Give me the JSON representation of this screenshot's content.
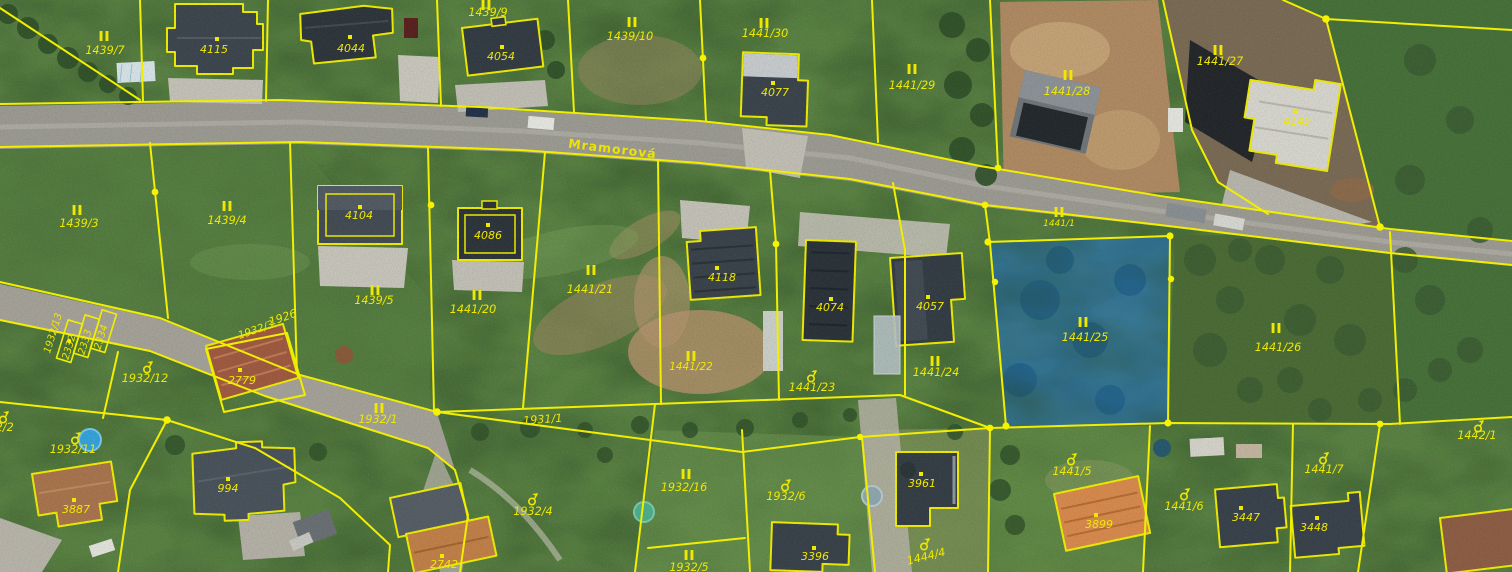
{
  "map": {
    "street_label": {
      "text": "Mramorová",
      "x": 612,
      "y": 153,
      "rotation": 7
    },
    "selection": {
      "parcel": "1441/25",
      "fill": "#1e6fd2",
      "fill_opacity": 0.55
    },
    "colors": {
      "boundary_line": "#f2ee00",
      "parcel_label": "#efe800",
      "selection_fill": "#1e6fd2"
    },
    "marker_legend": {
      "grass": "permanent-grassland-marker",
      "garden": "garden-marker",
      "dot": "building-point"
    },
    "parcel_labels": [
      {
        "label": "1439/7",
        "x": 105,
        "y": 54,
        "marker": {
          "type": "grass",
          "x": 104,
          "y": 36
        }
      },
      {
        "label": "1439/9",
        "x": 488,
        "y": 16,
        "marker": {
          "type": "grass",
          "x": 486,
          "y": 5
        }
      },
      {
        "label": "1439/10",
        "x": 630,
        "y": 40,
        "marker": {
          "type": "grass",
          "x": 632,
          "y": 22
        }
      },
      {
        "label": "1441/30",
        "x": 765,
        "y": 37,
        "marker": {
          "type": "grass",
          "x": 764,
          "y": 23
        }
      },
      {
        "label": "1441/29",
        "x": 912,
        "y": 89,
        "marker": {
          "type": "grass",
          "x": 912,
          "y": 69
        }
      },
      {
        "label": "1441/28",
        "x": 1067,
        "y": 95,
        "marker": {
          "type": "grass",
          "x": 1068,
          "y": 75
        }
      },
      {
        "label": "1441/27",
        "x": 1220,
        "y": 65,
        "marker": {
          "type": "grass",
          "x": 1218,
          "y": 50
        }
      },
      {
        "label": "1439/3",
        "x": 79,
        "y": 227,
        "marker": {
          "type": "grass",
          "x": 77,
          "y": 210
        }
      },
      {
        "label": "1439/4",
        "x": 227,
        "y": 224,
        "marker": {
          "type": "grass",
          "x": 227,
          "y": 206
        }
      },
      {
        "label": "1439/5",
        "x": 374,
        "y": 304,
        "marker": {
          "type": "grass",
          "x": 375,
          "y": 290
        }
      },
      {
        "label": "1441/20",
        "x": 473,
        "y": 313,
        "marker": {
          "type": "grass",
          "x": 477,
          "y": 295
        }
      },
      {
        "label": "1441/21",
        "x": 590,
        "y": 293,
        "marker": {
          "type": "grass",
          "x": 591,
          "y": 270
        }
      },
      {
        "label": "1441/22",
        "x": 691,
        "y": 370,
        "size": 10.5,
        "marker": {
          "type": "grass",
          "x": 691,
          "y": 356
        }
      },
      {
        "label": "1441/23",
        "x": 812,
        "y": 391,
        "marker": {
          "type": "garden",
          "x": 811,
          "y": 376
        }
      },
      {
        "label": "1441/24",
        "x": 936,
        "y": 376,
        "marker": {
          "type": "grass",
          "x": 935,
          "y": 361
        }
      },
      {
        "label": "1441/25",
        "x": 1085,
        "y": 341,
        "marker": {
          "type": "grass",
          "x": 1083,
          "y": 322
        }
      },
      {
        "label": "1441/26",
        "x": 1278,
        "y": 351,
        "marker": {
          "type": "grass",
          "x": 1276,
          "y": 328
        }
      },
      {
        "label": "1441/1",
        "x": 1059,
        "y": 226,
        "size": 9,
        "marker": {
          "type": "grass",
          "x": 1059,
          "y": 212
        }
      },
      {
        "label": "1926",
        "x": 284,
        "y": 321,
        "rotation": -19
      },
      {
        "label": "1932/3",
        "x": 257,
        "y": 333,
        "rotation": -19,
        "size": 10.5
      },
      {
        "label": "1932/13",
        "x": 56,
        "y": 334,
        "rotation": -73,
        "size": 10
      },
      {
        "label": "2332",
        "x": 72,
        "y": 348,
        "rotation": -73,
        "size": 10
      },
      {
        "label": "2333",
        "x": 88,
        "y": 343,
        "rotation": -73,
        "size": 10
      },
      {
        "label": "2334",
        "x": 104,
        "y": 338,
        "rotation": -73,
        "size": 10
      },
      {
        "label": "1932/12",
        "x": 145,
        "y": 382,
        "marker": {
          "type": "garden",
          "x": 147,
          "y": 367
        }
      },
      {
        "label": "1932/2",
        "x": -6,
        "y": 431,
        "marker": {
          "type": "garden",
          "x": 3,
          "y": 417
        }
      },
      {
        "label": "1932/11",
        "x": 73,
        "y": 453,
        "marker": {
          "type": "garden",
          "x": 75,
          "y": 438
        }
      },
      {
        "label": "1932/1",
        "x": 378,
        "y": 423,
        "marker": {
          "type": "grass",
          "x": 379,
          "y": 408
        }
      },
      {
        "label": "1931/1",
        "x": 543,
        "y": 423,
        "rotation": -4
      },
      {
        "label": "1932/4",
        "x": 533,
        "y": 515,
        "marker": {
          "type": "garden",
          "x": 532,
          "y": 499
        }
      },
      {
        "label": "1932/16",
        "x": 684,
        "y": 491,
        "marker": {
          "type": "grass",
          "x": 686,
          "y": 474
        }
      },
      {
        "label": "1932/5",
        "x": 689,
        "y": 571,
        "marker": {
          "type": "grass",
          "x": 689,
          "y": 555
        }
      },
      {
        "label": "1932/6",
        "x": 786,
        "y": 500,
        "marker": {
          "type": "garden",
          "x": 785,
          "y": 485
        }
      },
      {
        "label": "1444/4",
        "x": 927,
        "y": 560,
        "rotation": -14,
        "marker": {
          "type": "garden",
          "x": 924,
          "y": 544
        }
      },
      {
        "label": "1441/5",
        "x": 1072,
        "y": 475,
        "marker": {
          "type": "garden",
          "x": 1071,
          "y": 459
        }
      },
      {
        "label": "1441/6",
        "x": 1184,
        "y": 510,
        "marker": {
          "type": "garden",
          "x": 1184,
          "y": 494
        }
      },
      {
        "label": "1441/7",
        "x": 1324,
        "y": 473,
        "marker": {
          "type": "garden",
          "x": 1323,
          "y": 458
        }
      },
      {
        "label": "1442/1",
        "x": 1477,
        "y": 439,
        "marker": {
          "type": "garden",
          "x": 1478,
          "y": 426
        }
      }
    ],
    "building_labels": [
      {
        "label": "4115",
        "x": 214,
        "y": 53,
        "dot": {
          "x": 217,
          "y": 39
        }
      },
      {
        "label": "4044",
        "x": 351,
        "y": 52,
        "dot": {
          "x": 350,
          "y": 37
        }
      },
      {
        "label": "4054",
        "x": 501,
        "y": 60,
        "dot": {
          "x": 502,
          "y": 47
        }
      },
      {
        "label": "4077",
        "x": 775,
        "y": 96,
        "dot": {
          "x": 773,
          "y": 83
        }
      },
      {
        "label": "4149",
        "x": 1297,
        "y": 125,
        "dot": {
          "x": 1295,
          "y": 112
        }
      },
      {
        "label": "4104",
        "x": 359,
        "y": 219,
        "dot": {
          "x": 360,
          "y": 207
        }
      },
      {
        "label": "4086",
        "x": 488,
        "y": 239,
        "dot": {
          "x": 488,
          "y": 225
        }
      },
      {
        "label": "4118",
        "x": 722,
        "y": 281,
        "dot": {
          "x": 717,
          "y": 268
        }
      },
      {
        "label": "4074",
        "x": 830,
        "y": 311,
        "dot": {
          "x": 831,
          "y": 299
        }
      },
      {
        "label": "4057",
        "x": 930,
        "y": 310,
        "dot": {
          "x": 928,
          "y": 297
        }
      },
      {
        "label": "2779",
        "x": 242,
        "y": 384,
        "dot": {
          "x": 240,
          "y": 370
        }
      },
      {
        "label": "3887",
        "x": 76,
        "y": 513,
        "dot": {
          "x": 74,
          "y": 500
        }
      },
      {
        "label": "994",
        "x": 228,
        "y": 492,
        "dot": {
          "x": 228,
          "y": 479
        }
      },
      {
        "label": "2742",
        "x": 444,
        "y": 568,
        "dot": {
          "x": 442,
          "y": 556
        }
      },
      {
        "label": "3396",
        "x": 815,
        "y": 560,
        "dot": {
          "x": 814,
          "y": 548
        }
      },
      {
        "label": "3961",
        "x": 922,
        "y": 487,
        "dot": {
          "x": 921,
          "y": 474
        }
      },
      {
        "label": "3899",
        "x": 1099,
        "y": 528,
        "dot": {
          "x": 1096,
          "y": 515
        }
      },
      {
        "label": "3447",
        "x": 1246,
        "y": 521,
        "dot": {
          "x": 1241,
          "y": 508
        }
      },
      {
        "label": "3448",
        "x": 1314,
        "y": 531,
        "dot": {
          "x": 1317,
          "y": 518
        }
      }
    ]
  }
}
